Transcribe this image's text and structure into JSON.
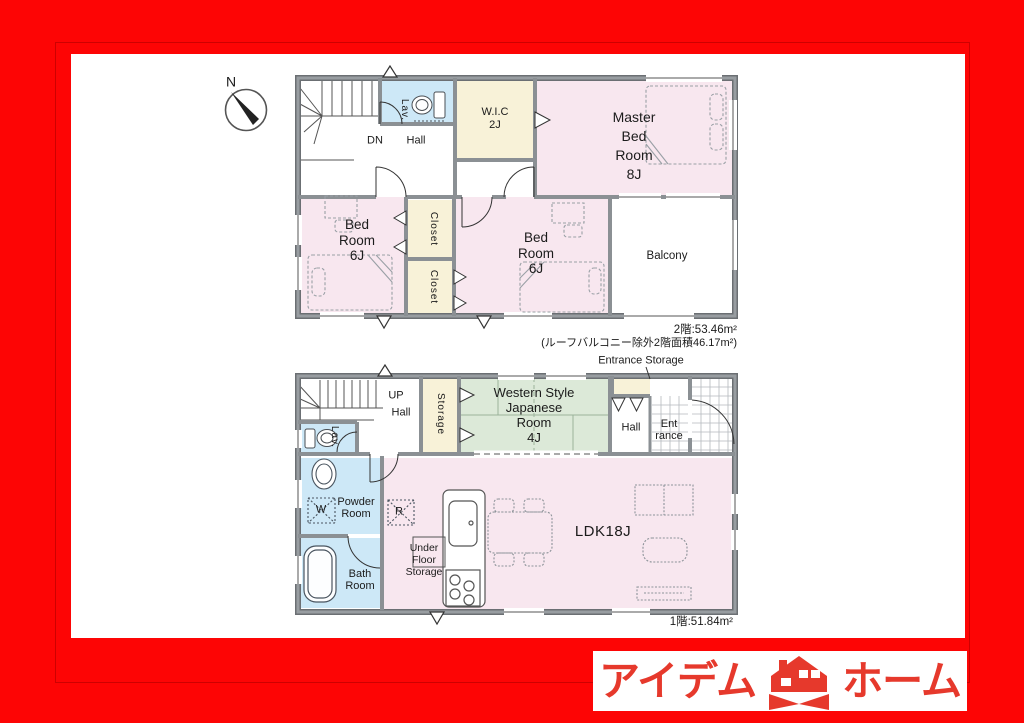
{
  "compass": {
    "north_label": "N"
  },
  "floor2": {
    "stairs_label": "DN",
    "hall_label": "Hall",
    "lav_label": "Lav.",
    "wic_label": "W.I.C\n2J",
    "master_bedroom_label": "Master\nBed\nRoom\n8J",
    "bedroom_left_label": "Bed\nRoom\n6J",
    "closet_top_label": "Closet",
    "closet_bottom_label": "Closet",
    "bedroom_center_label": "Bed\nRoom\n6J",
    "balcony_label": "Balcony",
    "area_text": "2階:53.46m²",
    "area_note": "(ルーフバルコニー除外2階面積46.17m²)"
  },
  "floor1": {
    "stairs_label": "UP",
    "hall_left_label": "Hall",
    "lav_label": "Lav.",
    "storage_label": "Storage",
    "japanese_room_label": "Western Style\nJapanese\nRoom\n4J",
    "entrance_storage_label": "Entrance Storage",
    "hall_right_label": "Hall",
    "entrance_label": "Ent\nrance",
    "powder_room_label": "Powder\nRoom",
    "washing_machine_label": "W",
    "bath_room_label": "Bath\nRoom",
    "refrigerator_label": "R",
    "under_floor_storage_label": "Under\nFloor\nStorage",
    "ldk_label": "LDK18J",
    "area_text": "1階:51.84m²"
  },
  "logo": {
    "brand_left": "アイデム",
    "brand_right": "ホーム"
  },
  "colors": {
    "frame_red": "#fd0505",
    "logo_red": "#e6392c",
    "room_pink": "#f8e7ef",
    "room_cream": "#f8f2d8",
    "room_blue": "#cde8f7",
    "room_green": "#dce9d8",
    "wall_gray": "#82868a"
  }
}
